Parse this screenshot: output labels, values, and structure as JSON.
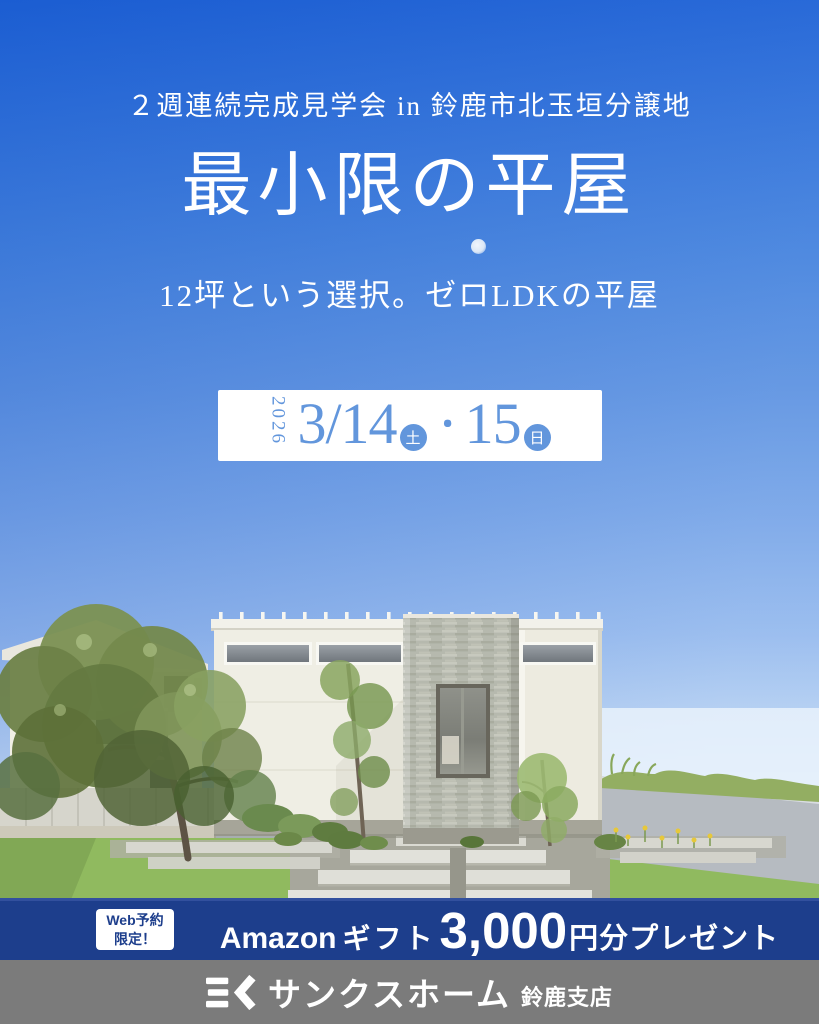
{
  "header": {
    "event_line": "２週連続完成見学会 in 鈴鹿市北玉垣分譲地",
    "title": "最小限の平屋",
    "subtitle": "12坪という選択。ゼロLDKの平屋"
  },
  "date_box": {
    "year": "2026",
    "day1": "3/14",
    "day1_dow": "土",
    "separator": "・",
    "day2": "15",
    "day2_dow": "日"
  },
  "banner": {
    "badge_line1": "Web予約",
    "badge_line2": "限定！",
    "amazon": "Amazon",
    "gift": "ギフト",
    "amount": "3,000",
    "suffix": "円分プレゼント"
  },
  "footer": {
    "company": "サンクスホーム",
    "branch": "鈴鹿支店"
  },
  "colors": {
    "banner_blue": "#1d3e8c",
    "date_blue": "#6296dc",
    "footer_gray": "#7b7b7b",
    "sky_top": "#1e62d6",
    "sky_horizon": "#f5fafd",
    "lawn_green": "#90ba5f",
    "wall_cream": "#efeee4",
    "stone_gray": "#b6b9ae"
  }
}
